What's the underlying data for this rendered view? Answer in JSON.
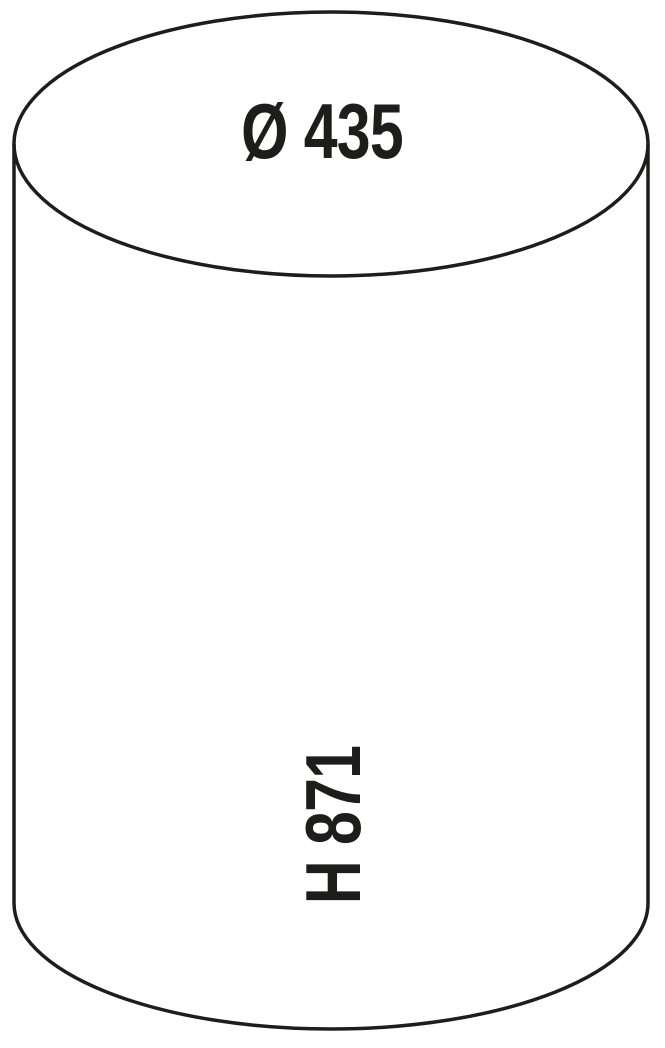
{
  "figure": {
    "kind": "cylinder-dimension-drawing",
    "colors": {
      "background": "#ffffff",
      "line": "#1d1d1b",
      "text": "#1d1d1b"
    },
    "labels": {
      "diameter": "Ø 435",
      "height": "H 871"
    },
    "values": {
      "diameter": 435,
      "height": 871
    }
  }
}
